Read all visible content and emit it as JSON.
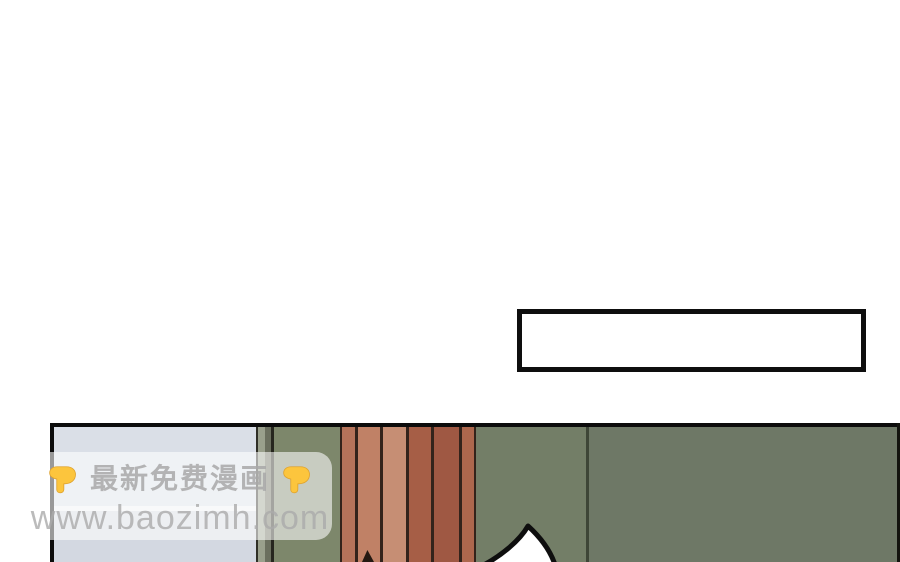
{
  "page": {
    "description": "comic reader page, mostly blank white with one panel at bottom",
    "background_color": "#ffffff"
  },
  "caption_box": {
    "text": "",
    "border_color": "#0e0e0e",
    "fill_color": "#ffffff"
  },
  "watermark": {
    "line1": "最新免费漫画",
    "line2": "www.baozimh.com",
    "left_icon": "down-pointing-hand-icon",
    "right_icon": "down-pointing-hand-icon",
    "icon_color": "#fcc53d",
    "box_color": "rgba(255,255,255,0.58)",
    "text_color": "#aaaaaa"
  },
  "panel": {
    "border_color": "#0c0c0c",
    "door_color": "#dadfe7",
    "door_highlight_color": "#eef0f3",
    "door_frame_color": "#9aa08c",
    "wall_left_color": "#7d876b",
    "wall_mid_color": "#737e67",
    "wall_right_color": "#6e7866",
    "wall_seam_color": "#3e4637",
    "plank_line_color": "#33231b",
    "plank_colors": [
      "#b5735a",
      "#c08166",
      "#c68e74",
      "#a65e46",
      "#9f5843",
      "#ad674d"
    ],
    "speech_bubble_fill": "#ffffff",
    "speech_bubble_outline": "#0e0e0e"
  }
}
